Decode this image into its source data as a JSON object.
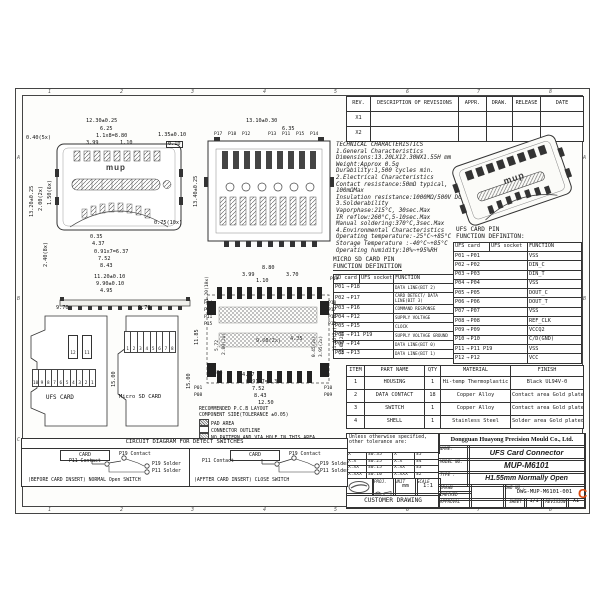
{
  "zones": {
    "top": [
      "1",
      "2",
      "3",
      "4",
      "5",
      "6",
      "7",
      "8"
    ],
    "bottom": [
      "1",
      "2",
      "3",
      "4",
      "5",
      "6",
      "7",
      "8"
    ],
    "left": [
      "A",
      "B",
      "C"
    ],
    "right": [
      "A",
      "B",
      "C"
    ]
  },
  "watermark": "C",
  "rev_table": {
    "headers": [
      "REV.",
      "DESCRIPTION OF REVISIONS",
      "APPR.",
      "DRAW.",
      "RELEASE",
      "DATE"
    ],
    "rows": [
      {
        "rev": "X1"
      },
      {
        "rev": "X2"
      }
    ]
  },
  "tech": {
    "lines": [
      "TECHNICAL CHARACTERISTICS",
      "1.General Characteristics",
      "Dimensions:13.20LX12.30WX1.55H mm",
      "Weight:Approx 0.5g",
      "Durability:1,500 cycles min.",
      "2.Electrical Characteristics",
      "Contact resistance:50mΩ typical,",
      "100mΩMax",
      "Insulation resistance:1000MΩ/500V DC",
      "3.Solderability",
      "Vaporphase:215°C, 30sec.Max",
      "IR reflow:260°C,5-10sec.Max",
      "Manual soldering:370°C,3sec.Max",
      "4.Environmental Characteristics",
      "Operating temperature:-25°C~+85°C",
      "Storage Temperature :-40°C~+85°C",
      "Operating humidity:10%~+95%RH"
    ]
  },
  "ufs_table": {
    "title1": "UFS CARD PIN",
    "title2": "FUNCTION DEFINITON:",
    "h_card": "UFS card",
    "h_socket": "UFS socket",
    "h_fn": "FUNCTION",
    "arrow": "→",
    "rows": [
      {
        "card": "P01",
        "socket": "P01",
        "fn": "VSS"
      },
      {
        "card": "P02",
        "socket": "P02",
        "fn": "DIN_C"
      },
      {
        "card": "P03",
        "socket": "P03",
        "fn": "DIN_T"
      },
      {
        "card": "P04",
        "socket": "P04",
        "fn": "VSS"
      },
      {
        "card": "P05",
        "socket": "P05",
        "fn": "DOUT_C"
      },
      {
        "card": "P06",
        "socket": "P06",
        "fn": "DOUT_T"
      },
      {
        "card": "P07",
        "socket": "P07",
        "fn": "VSS"
      },
      {
        "card": "P08",
        "socket": "P08",
        "fn": "REF_CLK"
      },
      {
        "card": "P09",
        "socket": "P09",
        "fn": "VCCQ2"
      },
      {
        "card": "P10",
        "socket": "P10",
        "fn": "C/D(GND)"
      },
      {
        "card": "P11",
        "socket": "P11 P19",
        "fn": "VSS"
      },
      {
        "card": "P12",
        "socket": "P12",
        "fn": "VCC"
      }
    ]
  },
  "sd_table": {
    "title1": "MICRO SD CARD PIN",
    "title2": "FUNCTION DEFINITION",
    "h_card": "SD card",
    "h_socket": "UFS socket",
    "h_fn": "FUNCTION",
    "arrow": "→",
    "rows": [
      {
        "card": "P01",
        "socket": "P18",
        "fn": "DATA LINE(BIT 2)"
      },
      {
        "card": "P02",
        "socket": "P17",
        "fn": "CARD DETECT/ DATA LINE(BIT 3)"
      },
      {
        "card": "P03",
        "socket": "P16",
        "fn": "COMMAND RESPONSE"
      },
      {
        "card": "P04",
        "socket": "P12",
        "fn": "SUPPLY VOLTAGE"
      },
      {
        "card": "P05",
        "socket": "P15",
        "fn": "CLOCK"
      },
      {
        "card": "P06",
        "socket": "P11 P19",
        "fn": "SUPPLY VOLTAGE GROUND"
      },
      {
        "card": "P07",
        "socket": "P14",
        "fn": "DATA LINE(BIT 0)"
      },
      {
        "card": "P08",
        "socket": "P13",
        "fn": "DATA LINE(BIT 1)"
      }
    ]
  },
  "parts_table": {
    "headers": [
      "ITEM",
      "PART NAME",
      "QTY",
      "MATERIAL",
      "FINISH"
    ],
    "rows": [
      {
        "item": "1",
        "name": "HOUSING",
        "qty": "1",
        "material": "Hi-temp Thermoplastic",
        "finish": "Black UL94V-0"
      },
      {
        "item": "2",
        "name": "DATA CONTACT",
        "qty": "18",
        "material": "Copper Alloy",
        "finish": "Contact area Gold plated"
      },
      {
        "item": "3",
        "name": "SWITCH",
        "qty": "1",
        "material": "Copper Alloy",
        "finish": "Contact area Gold plated"
      },
      {
        "item": "4",
        "name": "SHELL",
        "qty": "1",
        "material": "Stainless Steel",
        "finish": "Solder area Gold plated"
      }
    ]
  },
  "tolerance": {
    "note": "Unless otherwise specified, other tolerance are:",
    "rows": [
      {
        "a": "X",
        "b": "±0.35",
        "c": "X°",
        "d": "±5°"
      },
      {
        "a": "X.X",
        "b": "±0.25",
        "c": "X.X°",
        "d": "±4°"
      },
      {
        "a": "X.XX",
        "b": "±0.15",
        "c": "X.XX°",
        "d": "±3°"
      },
      {
        "a": "X.XXX",
        "b": "±0.10",
        "c": "X.XXX°",
        "d": "±2°"
      }
    ]
  },
  "title_block": {
    "company": "Dongguan Huayong Precision Mould Co., Ltd.",
    "name_label": "NAME:",
    "name": "UFS Card Connector",
    "model_label": "MODEL NO.",
    "model": "MUP-M6101",
    "type_label": "TYPE :",
    "type": "H1.55mm Normally Open",
    "proj_label": "PROJ.",
    "unit_label": "UNIT",
    "unit": "mm",
    "scale_label": "SCALE",
    "scale": "1:1",
    "drawn_label": "DRAWN",
    "checked_label": "CHECKED",
    "approval_label": "APPROVAL",
    "dwg_label": "DWG NO :",
    "dwg_no": "DWG-MUP-M6101-001",
    "sheet_label": "SHEET",
    "sheet": "1/1",
    "revision_label": "REVISION",
    "revision": "X1",
    "footer": "CUSTOMER DRAWING"
  },
  "view1": {
    "logo": "mup",
    "dims": [
      "12.30±0.25",
      "6.25",
      "1.1x8=8.80",
      "3.99",
      "1.10",
      "0.40(5x)",
      "1.35±0.10",
      "0.10",
      "13.20±0.25",
      "2.00(2x)",
      "1.50(6x)",
      "0.75(10x)",
      "0.35",
      "4.37",
      "0.91x7=6.37",
      "7.52",
      "8.43",
      "2.40(8x)"
    ]
  },
  "side_view": {
    "dims": [
      "11.20±0.10",
      "9.90±0.10",
      "4.95"
    ]
  },
  "view2": {
    "dims": [
      "13.10±0.30",
      "6.35",
      "13.40±0.25"
    ],
    "pins_top": [
      "P17",
      "P18",
      "P12",
      "P13",
      "P11",
      "P15",
      "P14"
    ]
  },
  "view3": {
    "dims": [
      "1.20(10x)",
      "8.80",
      "3.99",
      "1.10",
      "3.70",
      "11.85",
      "5.72",
      "2.80(2x)",
      "9.60(2x)",
      "4.35",
      "0.45(2x)",
      "3.95(2x)",
      "11.45(2x)",
      "12.60(2x)",
      "1.88",
      "4.37",
      "0.91x7=6.37",
      "7.52",
      "8.43",
      "12.50",
      "15.00"
    ],
    "pin_top": "P19",
    "pins_left": [
      "P14",
      "P13",
      "P11",
      "P15"
    ],
    "pins_right": [
      "P18",
      "P17",
      "P16",
      "P12"
    ],
    "pins_bottom_left": [
      "P01",
      "P08"
    ],
    "pins_bottom_right": [
      "P10",
      "P09"
    ]
  },
  "pcb_legend": {
    "line1": "RECOMMENDED P.C.B LAYOUT",
    "line2": "COMPONENT SIDE(TOLERANCE ±0.05)",
    "pad": "PAD AREA",
    "outline": "CONNECTOR OUTLINE",
    "nopattern": "NO PATTERN AND VIA HOLE IN THIS AREA"
  },
  "cards": {
    "ufs_label": "UFS CARD",
    "sd_label": "Micro SD CARD",
    "ufs_width": "9.70",
    "sd_width": "9.70",
    "ufs_height": "15.00",
    "ufs_pins_top": [
      "12",
      "11"
    ],
    "ufs_pins": [
      "10",
      "9",
      "8",
      "7",
      "6",
      "5",
      "4",
      "3",
      "2",
      "1"
    ],
    "sd_pins": [
      "1",
      "2",
      "3",
      "4",
      "5",
      "6",
      "7",
      "8"
    ]
  },
  "circuit": {
    "title": "CIRCUIT DIAGRAM FOR DETECT SWITCHES",
    "card_label": "CARD",
    "p11_contact": "P11 Contact",
    "p19_contact": "P19 Contact",
    "p19_solder": "P19 Solder",
    "p11_solder": "P11 Solder",
    "left_caption": "(BEFORE CARD INSERT) NORMAL Open SWITCH",
    "right_caption": "(AFFTER CARD INSERT) CLOSE SWITCH"
  },
  "iso": {
    "logo": "mup"
  }
}
